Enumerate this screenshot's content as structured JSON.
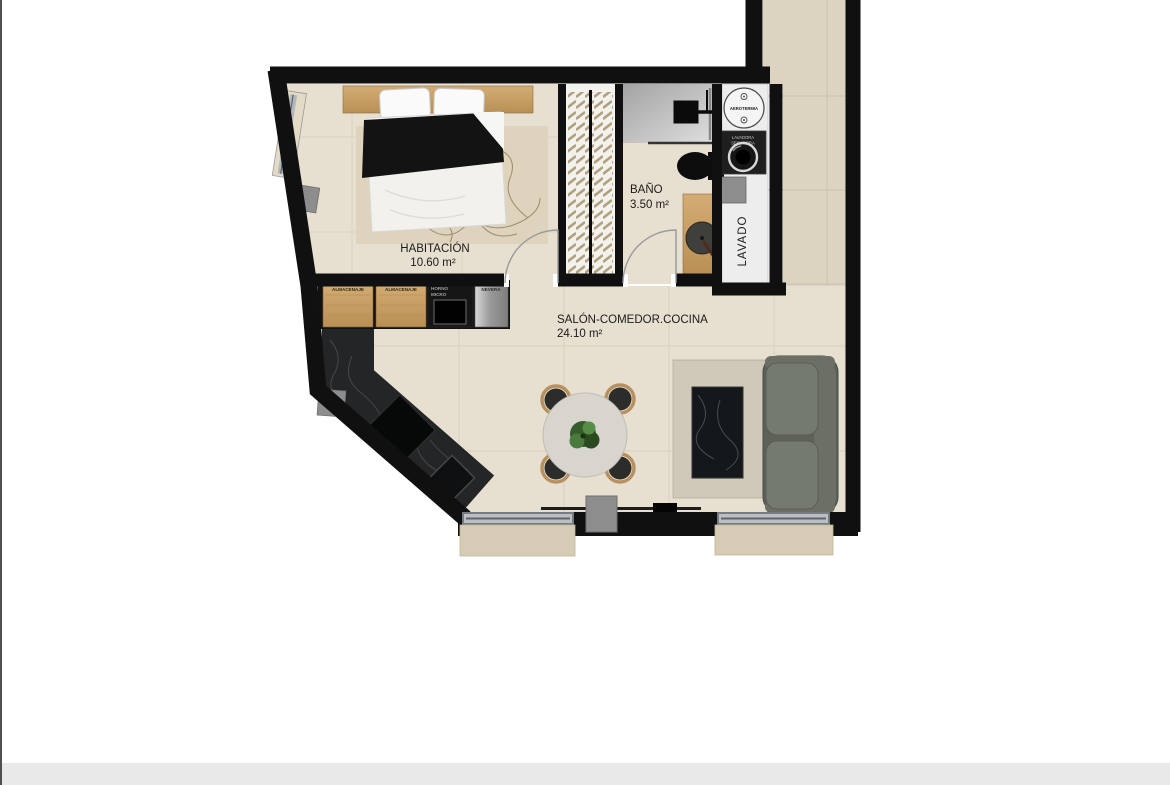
{
  "page": {
    "background_color": "#ffffff",
    "footer_bar_color": "#e9e9e9",
    "left_edge_line_color": "#4f4f4f"
  },
  "floor_plan": {
    "rooms": [
      {
        "id": "habitacion",
        "label": "HABITACIÓN",
        "area": "10.60 m²"
      },
      {
        "id": "bano",
        "label": "BAÑO",
        "area": "3.50 m²"
      },
      {
        "id": "salon",
        "label": "SALÓN-COMEDOR.COCINA",
        "area": "24.10 m²"
      },
      {
        "id": "lavado",
        "label": "LAVADO"
      }
    ],
    "appliances": {
      "aerotermia_label": "AEROTERMIA",
      "washer_label_line1": "LAVADORA",
      "washer_label_line2": "SECADORA"
    },
    "kitchen_units": [
      {
        "line1": "ALMACENAJE",
        "line2": ""
      },
      {
        "line1": "ALMACENAJE",
        "line2": ""
      },
      {
        "line1": "HORNO",
        "line2": "MICRO"
      },
      {
        "line1": "NEVERA",
        "line2": ""
      }
    ],
    "colors": {
      "wall": "#101010",
      "floor": "#e7dfd0",
      "terrace_floor": "#ddd3c1",
      "grout": "#d2c8b5",
      "wood": "#c8a066",
      "laundry_floor": "#ededed",
      "marble_counter": "#232527",
      "sofa_base": "#5d6159",
      "rug": "#d9d2c2",
      "pillar_gray": "#8d8d8d",
      "label_text": "#1b1b1b"
    }
  }
}
